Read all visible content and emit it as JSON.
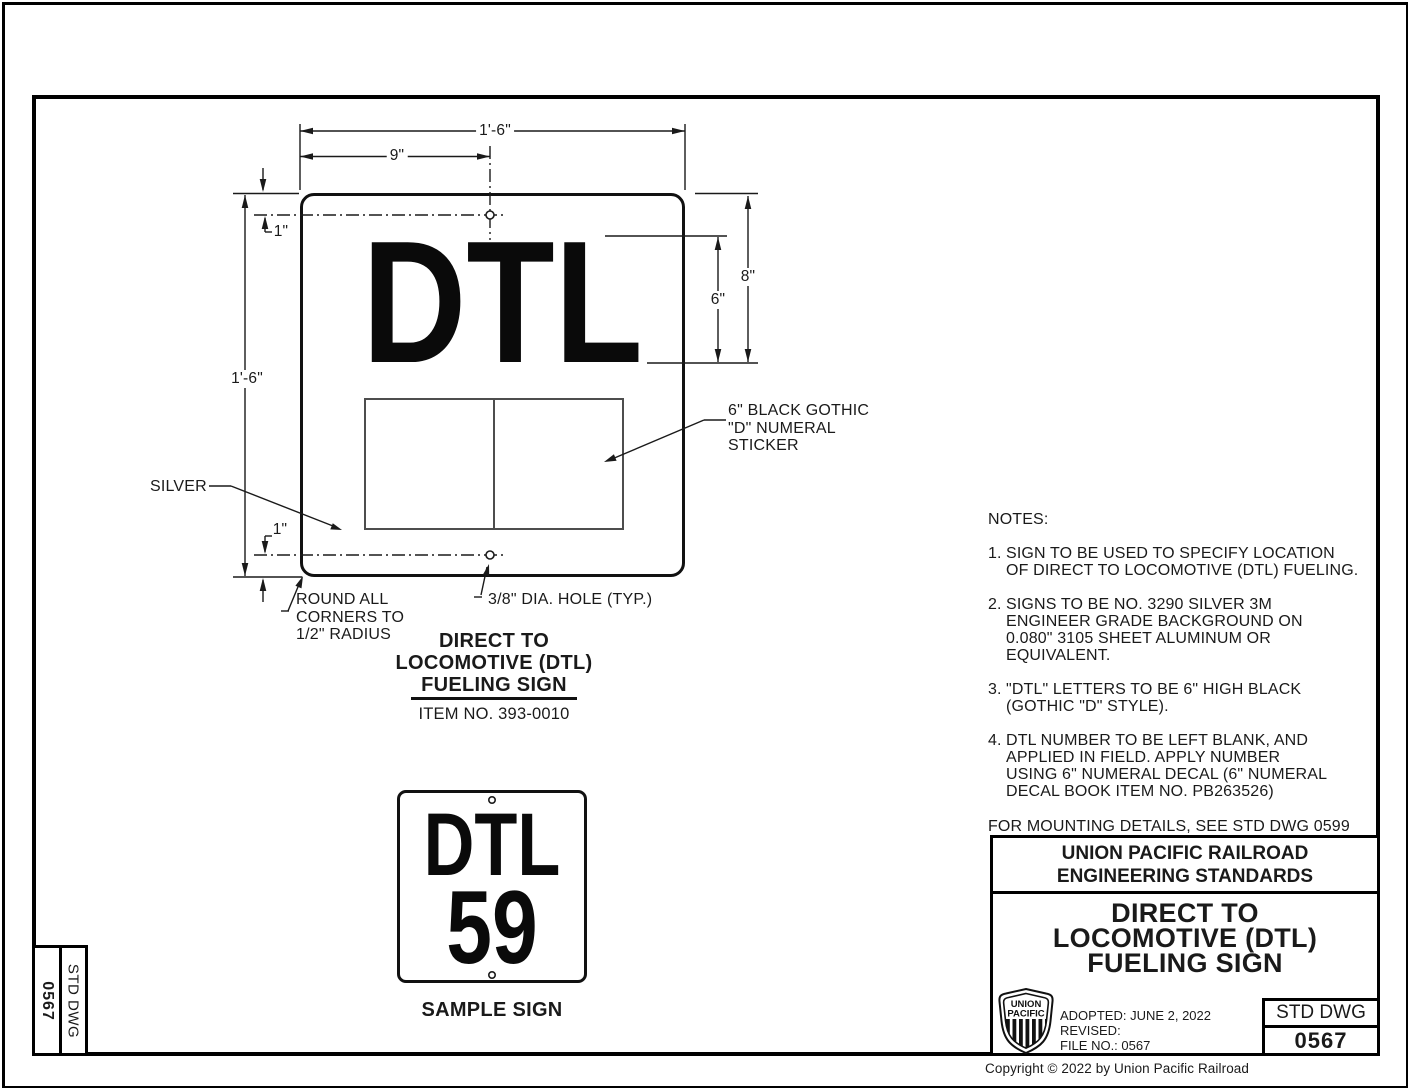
{
  "colors": {
    "ink": "#1a1a1a",
    "paper": "#ffffff",
    "sticker_outline": "#4d4d4d"
  },
  "drawing": {
    "sign": {
      "letters": "DTL"
    },
    "dims": {
      "overall_width": "1'-6\"",
      "hole_offset": "9\"",
      "top_hole_margin": "1\"",
      "letters_to_top": "8\"",
      "letter_height": "6\"",
      "overall_height": "1'-6\"",
      "bottom_hole_margin": "1\""
    },
    "callouts": {
      "silver": "SILVER",
      "sticker_line1": "6\" BLACK GOTHIC",
      "sticker_line2": "\"D\" NUMERAL",
      "sticker_line3": "STICKER",
      "corners_line1": "ROUND ALL",
      "corners_line2": "CORNERS TO",
      "corners_line3": "1/2\" RADIUS",
      "hole": "3/8\" DIA. HOLE (TYP.)"
    },
    "caption": {
      "line1": "DIRECT TO",
      "line2": "LOCOMOTIVE (DTL)",
      "line3": "FUELING SIGN",
      "item_no": "ITEM NO. 393-0010"
    }
  },
  "sample": {
    "letters": "DTL",
    "number": "59",
    "caption": "SAMPLE SIGN"
  },
  "notes": {
    "heading": "NOTES:",
    "items": [
      {
        "num": "1.",
        "lines": [
          "SIGN TO BE USED TO SPECIFY LOCATION",
          "OF DIRECT TO LOCOMOTIVE (DTL) FUELING."
        ]
      },
      {
        "num": "2.",
        "lines": [
          "SIGNS TO BE NO. 3290 SILVER 3M",
          "ENGINEER GRADE BACKGROUND ON",
          "0.080\" 3105 SHEET ALUMINUM OR",
          "EQUIVALENT."
        ]
      },
      {
        "num": "3.",
        "lines": [
          "\"DTL\" LETTERS TO BE 6\" HIGH BLACK",
          "(GOTHIC \"D\" STYLE)."
        ]
      },
      {
        "num": "4.",
        "lines": [
          "DTL NUMBER TO BE LEFT BLANK, AND",
          "APPLIED IN FIELD.  APPLY NUMBER",
          "USING 6\" NUMERAL DECAL (6\" NUMERAL",
          "DECAL BOOK ITEM NO. PB263526)"
        ]
      }
    ],
    "footer": "FOR MOUNTING DETAILS, SEE STD DWG 0599"
  },
  "title_block": {
    "org_line1": "UNION PACIFIC RAILROAD",
    "org_line2": "ENGINEERING STANDARDS",
    "title_line1": "DIRECT TO",
    "title_line2": "LOCOMOTIVE (DTL)",
    "title_line3": "FUELING SIGN",
    "adopted": "ADOPTED: JUNE 2, 2022",
    "revised": "REVISED:",
    "file_no": "FILE NO.: 0567",
    "std_dwg_label": "STD DWG",
    "std_dwg_number": "0567",
    "logo_line1": "UNION",
    "logo_line2": "PACIFIC"
  },
  "side_tab": {
    "number": "0567",
    "label": "STD DWG"
  },
  "page_footer": {
    "copyright": "Copyright © 2022 by Union Pacific Railroad"
  }
}
